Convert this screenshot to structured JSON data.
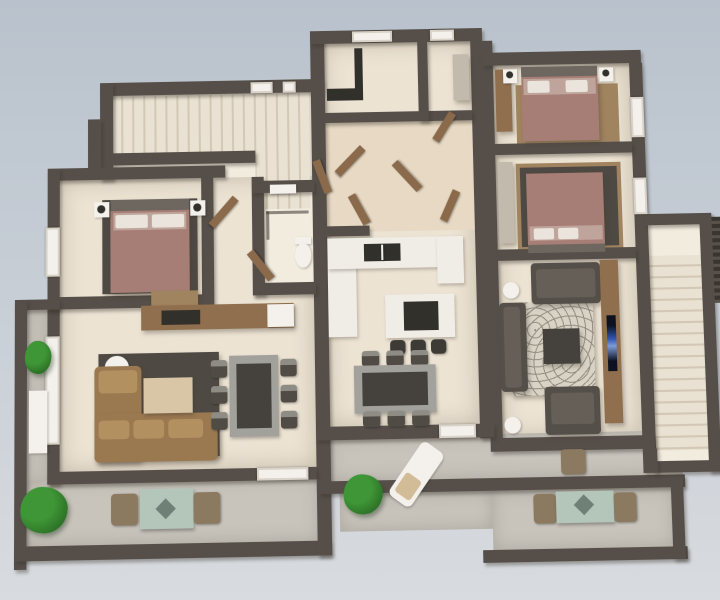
{
  "scene": {
    "description": "3D dollhouse-style render of an apartment floor plan viewed from above, on a plain blue-grey background",
    "view": "top-down three-quarter architectural render",
    "units": [
      {
        "name": "left-apartment",
        "rooms": [
          {
            "name": "bedroom",
            "contents": [
              "double bed with mauve bedding",
              "dark area rug",
              "2 white nightstands with black lamps",
              "window in left wall"
            ]
          },
          {
            "name": "hallway",
            "contents": [
              "open wooden door"
            ]
          },
          {
            "name": "bathroom",
            "contents": [
              "walk-in shower with glass screen",
              "white toilet",
              "ceiling light",
              "open wooden door"
            ]
          },
          {
            "name": "living-kitchen",
            "contents": [
              "wooden kitchen counter with dark cooktop",
              "white fridge",
              "wooden sideboard",
              "brown L-shaped sofa with cushions",
              "dark charcoal rug",
              "white round side table",
              "beige coffee table",
              "grey dining table with 6 chairs",
              "tall white window-door in left wall",
              "white sliding door to balcony"
            ]
          },
          {
            "name": "balcony",
            "contents": [
              "concrete floor",
              "2 green shrubs",
              "white storage cabinet",
              "glass bistro table with 2 chairs",
              "dark parapet walls"
            ]
          }
        ]
      },
      {
        "name": "middle-apartment",
        "rooms": [
          {
            "name": "laundry-room",
            "contents": [
              "dark counter",
              "tall dark appliance",
              "window in top wall"
            ]
          },
          {
            "name": "bathroom-2",
            "contents": [
              "window in top wall",
              "grey closet"
            ]
          },
          {
            "name": "hallway",
            "contents": [
              "several open wooden doors"
            ]
          },
          {
            "name": "kitchen-dining",
            "contents": [
              "white L-shaped counter with dark sink",
              "tall white cabinet",
              "white kitchen island with dark cooktop",
              "3 dark bar stools",
              "grey dining table with 6 chairs",
              "white door to balcony"
            ]
          },
          {
            "name": "balcony",
            "contents": [
              "green shrub",
              "white sun lounger with towel",
              "stepped concrete terraces"
            ]
          }
        ]
      },
      {
        "name": "right-apartment",
        "rooms": [
          {
            "name": "bedroom-1",
            "contents": [
              "double bed with mauve bedding",
              "wooden wardrobe",
              "2 white nightstands with black lamps",
              "wood floor area",
              "window in right wall"
            ]
          },
          {
            "name": "bedroom-2",
            "contents": [
              "double bed with mauve bedding (headboard at bottom)",
              "grey wardrobe",
              "dark rug on wood floor",
              "window in right wall"
            ]
          },
          {
            "name": "living-room",
            "contents": [
              "2 dark grey sofas",
              "dark armchair",
              "swirl-patterned rug",
              "dark square coffee table",
              "2 white round side tables",
              "wooden TV console along right wall",
              "flat TV with blue screen"
            ]
          },
          {
            "name": "balcony",
            "contents": [
              "glass bistro table with 2 chairs",
              "extra outdoor chair",
              "concrete floor",
              "dark parapet walls"
            ]
          }
        ]
      },
      {
        "name": "common-areas",
        "rooms": [
          {
            "name": "entry-stairwell-top-left",
            "contents": [
              "two stair flights with treads",
              "landing",
              "2 small windows in top wall"
            ]
          },
          {
            "name": "side-stairwell-right",
            "contents": [
              "long straight staircase",
              "upper landing",
              "louvered dark panel outside"
            ]
          }
        ]
      }
    ],
    "counts": {
      "beds": 3,
      "sofas": 3,
      "armchairs": 1,
      "dining_tables": 2,
      "dining_chairs": 12,
      "bar_stools": 3,
      "balcony_tables": 2,
      "shrubs": 4,
      "stairwells": 2,
      "tvs": 1
    }
  },
  "palette": {
    "sky_top": "#b9c2cc",
    "sky_bottom": "#d8dbdf",
    "wall": "#564f49",
    "floor": "#ece3d3",
    "floor_warm": "#e7d9c3",
    "floor_light": "#f2ecdf",
    "concrete": "#c8c4bc",
    "wood": "#8f6f4e",
    "wood_light": "#a0835f",
    "door_wood": "#8a6a4b",
    "bed": "#a67e75",
    "bed_light": "#bfa49b",
    "headboard": "#6e6760",
    "pillow": "#eae4dc",
    "rug_dark": "#4e4a43",
    "swirl_base": "#d9d3c6",
    "swirl_ink": "#948d80",
    "sofa_brown": "#9a7850",
    "sofa_brown_light": "#b2905f",
    "sofa_dark": "#544f48",
    "sofa_dark_light": "#655f57",
    "table_grey": "#a3a19c",
    "table_top": "#45423d",
    "chair_dark": "#504c45",
    "chair_light": "#8f8c86",
    "counter_white": "#f0ede7",
    "appliance_dark": "#32302b",
    "closet": "#c2bbad",
    "stool": "#3e3b36",
    "plant": "#3f9636",
    "plant_dark": "#2b6f26",
    "glass": "#b4c5b9",
    "glass_detail": "#6f8076",
    "outdoor_chair": "#8b7960",
    "coffee_table": "#d8c6a6",
    "tv_dark": "#0e1220",
    "tv_glow": "#2f54b0",
    "white_fixture": "#f4f1ec",
    "stair_tread": "#e9e1d1",
    "stair_gap": "#d2c8b5"
  }
}
